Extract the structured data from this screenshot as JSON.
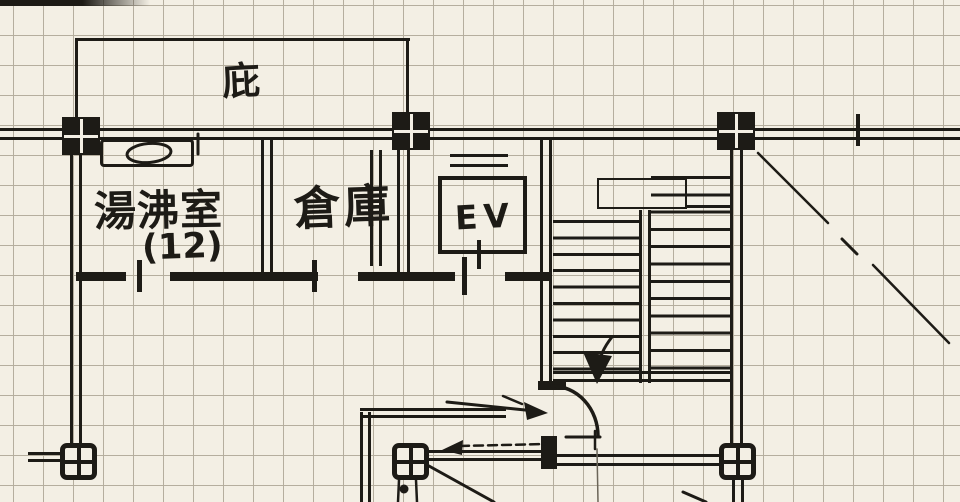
{
  "labels": {
    "canopy": "庇",
    "kitchenette": "湯沸室",
    "kitchenette_number": "(12)",
    "storage": "倉庫",
    "elevator": "EV"
  },
  "colors": {
    "paper": "#f3efe4",
    "ink": "#1d1b16",
    "grid": "#b5ae9e",
    "pencil": "#6b6558"
  },
  "icons": {
    "stair_direction": "down-arrow-icon",
    "corridor_entry": "right-arrow-icon",
    "corridor_exit": "dashed-left-arrow-icon"
  }
}
